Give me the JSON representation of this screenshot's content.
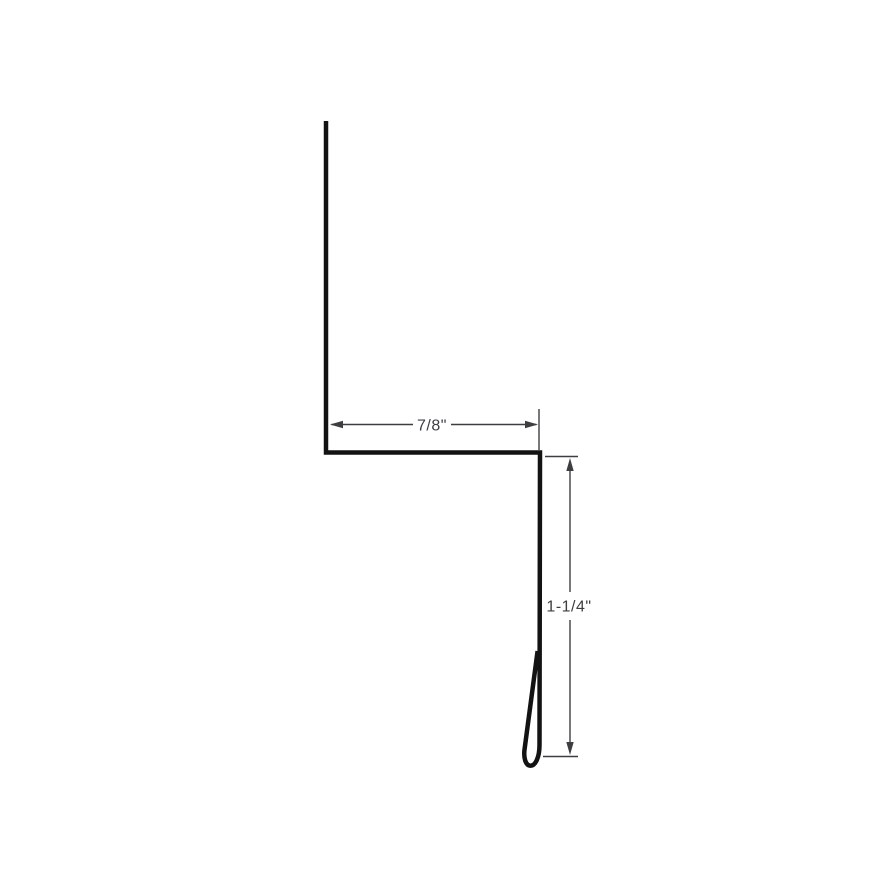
{
  "page": {
    "background_color": "#ffffff"
  },
  "profile": {
    "line_color": "#131313"
  },
  "dimensions": {
    "line_color": "#3e3e42",
    "width": {
      "label": "7/8\""
    },
    "height": {
      "label": "1-1/4\""
    }
  }
}
